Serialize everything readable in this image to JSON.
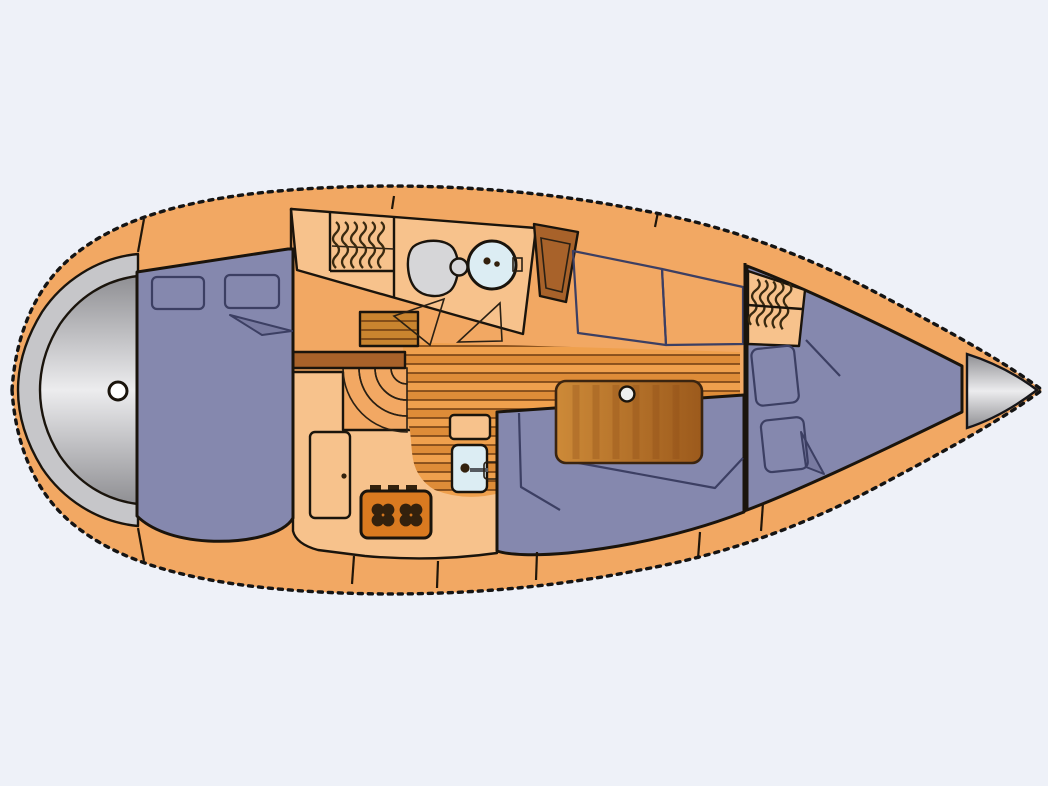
{
  "figure": {
    "title": "Sailboat interior layout plan, top view, bow to the right",
    "type": "floor-plan",
    "orientation": "bow-right"
  },
  "colors": {
    "background": "#eef1f8",
    "deck": "#f2a863",
    "floor_light": "#f7c28c",
    "upholstery": "#8588ae",
    "upholstery_line": "#3c3f63",
    "wood_dark": "#a8622a",
    "wood_mid": "#c9842f",
    "wood_light": "#e5a65b",
    "wood_line": "#6e3c12",
    "table_light": "#cd8a38",
    "table_dark": "#9c5a1c",
    "sole_base": "#efa04d",
    "sole_dark": "#de8c38",
    "gray_light": "#ececee",
    "gray_mid": "#c6c6c9",
    "gray_dark": "#8f8f93",
    "sink_blue": "#dcedf3",
    "toilet_gray": "#d6d6d8",
    "stove_orange": "#d97a20",
    "appliance_dark": "#33210d",
    "hull_line": "#141414",
    "white": "#ffffff"
  },
  "components": {
    "stern_platform": "stern swim platform",
    "stern_fitting": "round transom fitting",
    "aft_berth": "aft double berth",
    "aft_berth_pillows": "two pillows",
    "aft_hanging_locker": "hanging locker (aft)",
    "head_toilet": "marine toilet",
    "head_sink": "round washbasin",
    "head_door": "wood door",
    "companionway_steps": "curved companionway steps",
    "galley_locker": "galley locker door",
    "galley_stove": "two-burner stove",
    "galley_sink": "galley sink with faucet",
    "cabin_sole": "wood plank cabin sole",
    "saloon_table": "saloon table with cup recess",
    "settee_port": "port settee cushions",
    "settee_starboard": "starboard L-settee",
    "forward_hanging_locker": "hanging locker (forward)",
    "v_berth": "V-berth",
    "v_berth_pillows": "two pillows",
    "bow_cone": "bow / anchor locker cone"
  }
}
